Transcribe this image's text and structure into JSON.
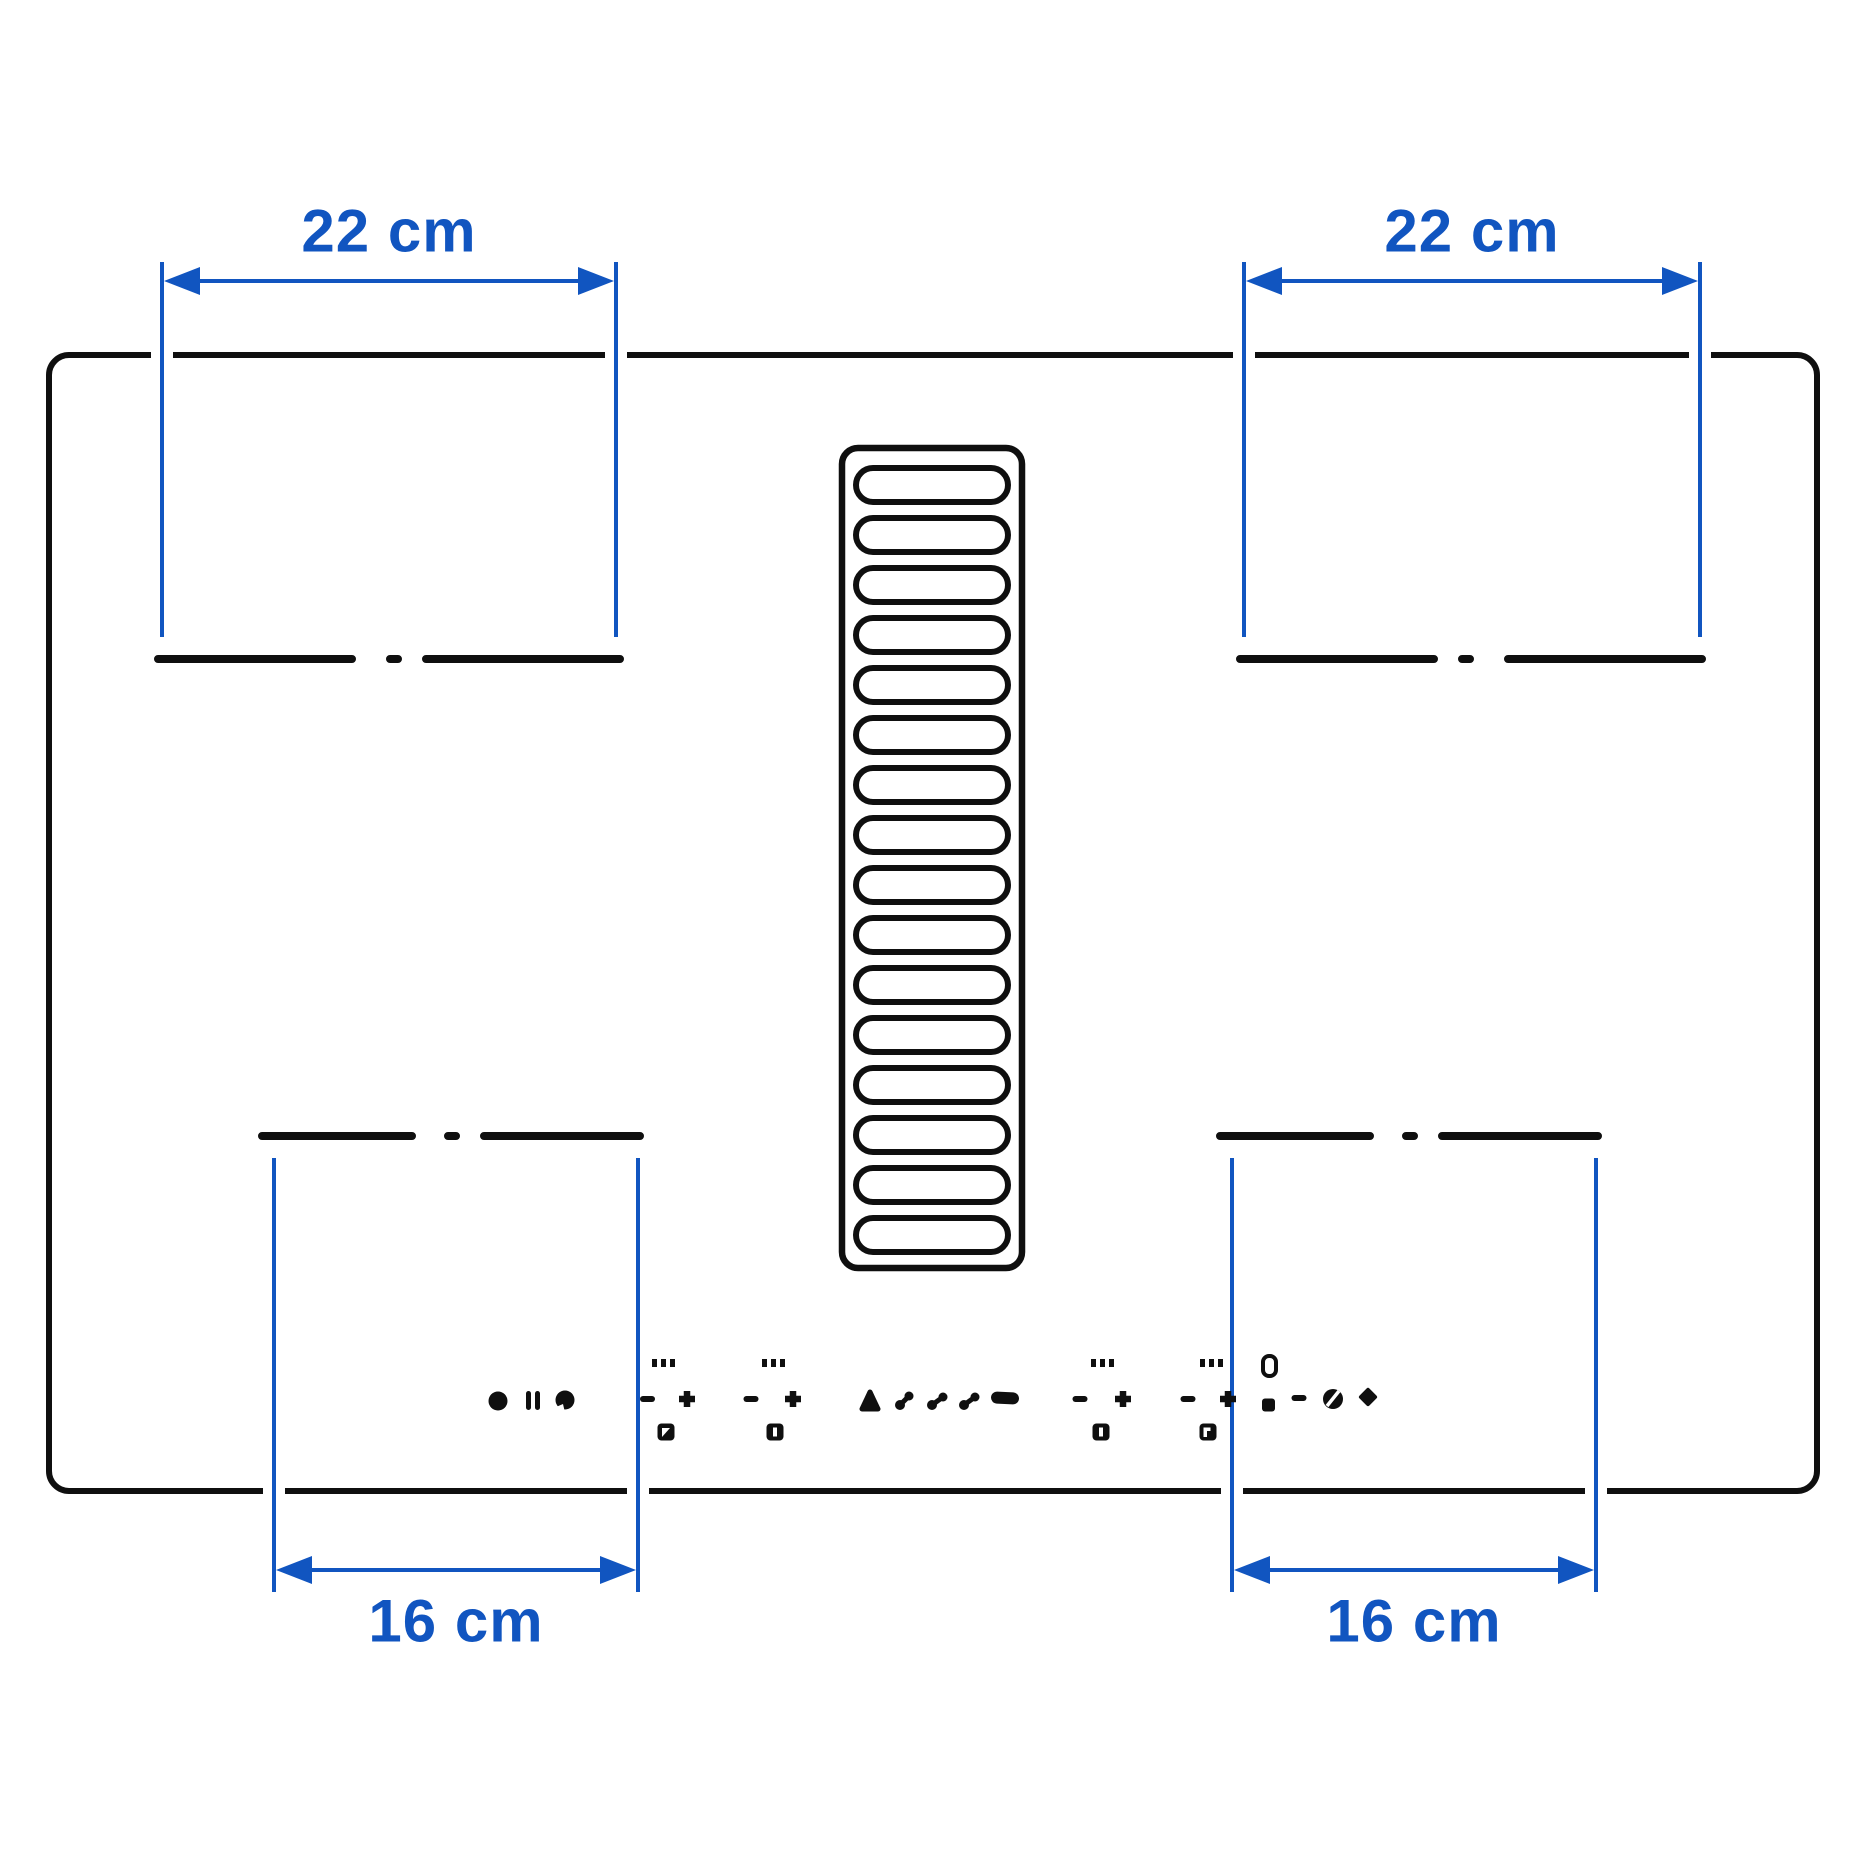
{
  "colors": {
    "background": "#ffffff",
    "line": "#0f0f0f",
    "accent": "#1155c0"
  },
  "dimensions": {
    "top_left": {
      "label": "22 cm",
      "value": 22,
      "unit": "cm"
    },
    "top_right": {
      "label": "22 cm",
      "value": 22,
      "unit": "cm"
    },
    "bottom_left": {
      "label": "16 cm",
      "value": 16,
      "unit": "cm"
    },
    "bottom_right": {
      "label": "16 cm",
      "value": 16,
      "unit": "cm"
    }
  },
  "grille": {
    "slot_count": 16
  },
  "control_icons": [
    "power-icon",
    "pause-icon",
    "lock-icon",
    "zone-rear-left-level-indicator",
    "minus-icon",
    "plus-icon",
    "zone-rear-left-select-icon",
    "zone-front-left-level-indicator",
    "minus-icon",
    "plus-icon",
    "zone-front-left-select-icon",
    "auto-mode-icon",
    "fan-speed-1-icon",
    "fan-speed-2-icon",
    "fan-speed-3-icon",
    "grease-filter-icon",
    "zone-rear-right-level-indicator",
    "minus-icon",
    "plus-icon",
    "zone-rear-right-select-icon",
    "zone-front-right-level-indicator",
    "minus-icon",
    "plus-icon",
    "zone-front-right-select-icon",
    "timer-display-icon",
    "timer-indicator-icon",
    "minus-icon",
    "clock-icon",
    "booster-diamond-icon"
  ]
}
